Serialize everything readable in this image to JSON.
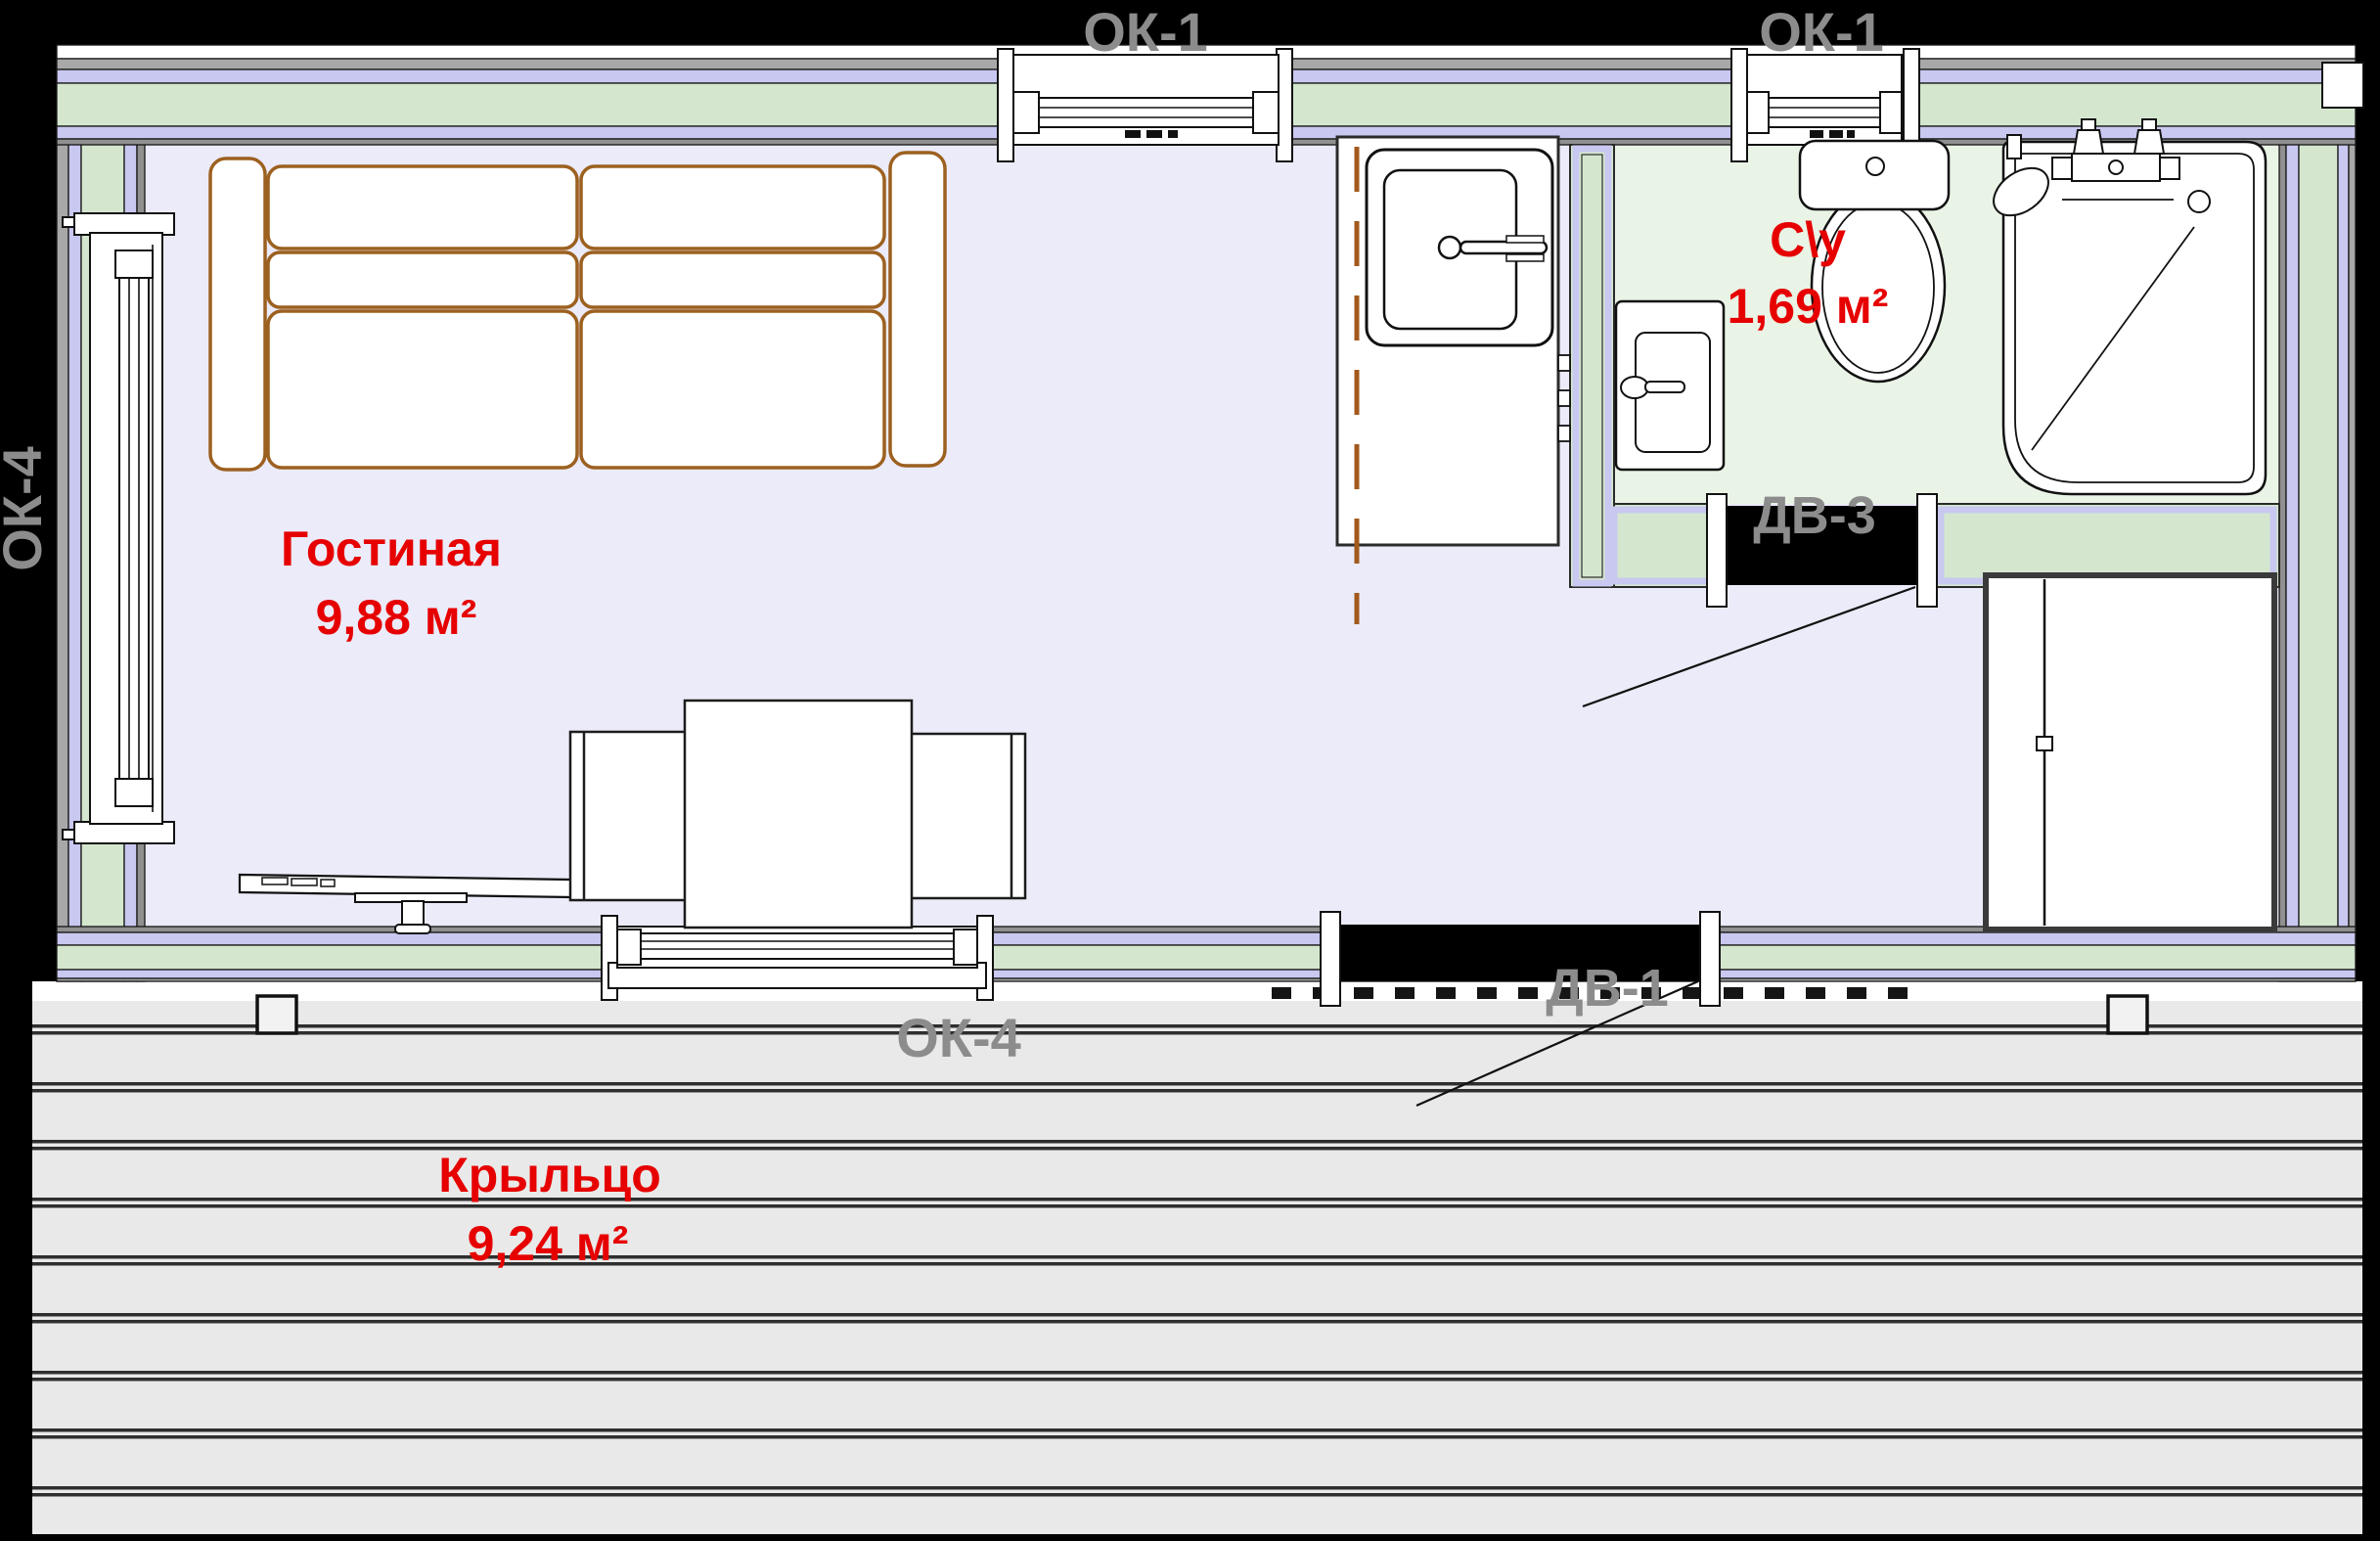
{
  "plan": {
    "rooms": {
      "living": {
        "name": "Гостиная",
        "area": "9,88 м²"
      },
      "bathroom": {
        "name": "С\\у",
        "area": "1,69 м²"
      },
      "porch": {
        "name": "Крыльцо",
        "area": "9,24 м²"
      }
    },
    "windows": {
      "ok1": "ОК-1",
      "ok4": "ОК-4"
    },
    "doors": {
      "dv1": "ДВ-1",
      "dv3": "ДВ-3"
    },
    "colors": {
      "wall_fill": "#d4e7ce",
      "wall_trim_lavender": "#c8c8f0",
      "wall_trim_gray": "#a8a8a8",
      "living_floor": "#ebebf9",
      "bathroom_floor": "#e9f3e6",
      "porch_deck": "#e9e9e9",
      "room_label_red": "#e60000",
      "tag_label_gray": "#8c8c8c",
      "furniture_wood": "#9c601f"
    }
  }
}
